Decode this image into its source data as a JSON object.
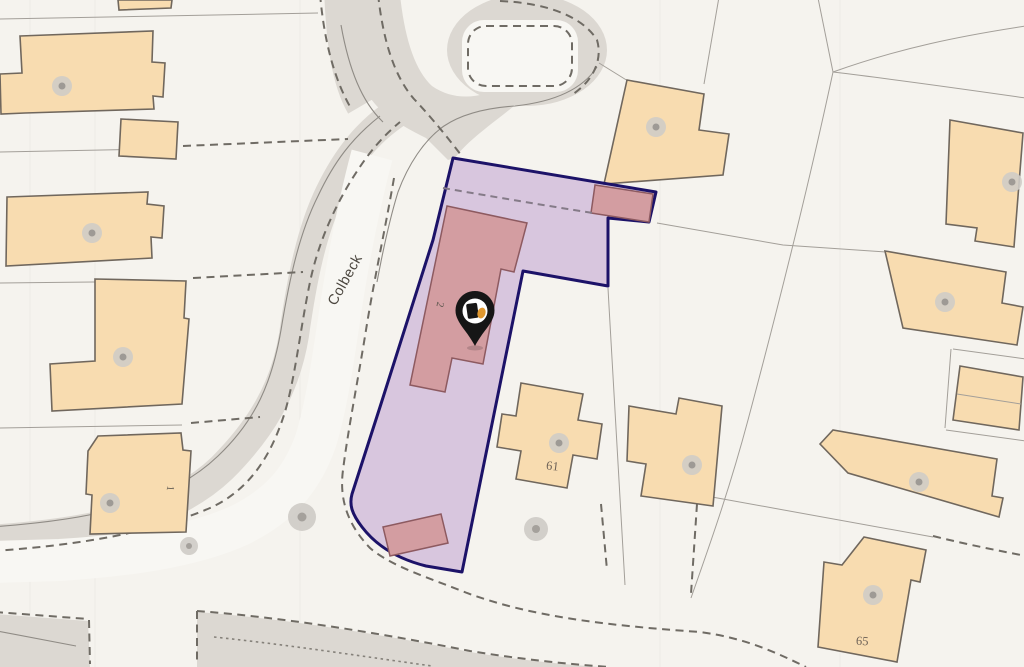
{
  "map": {
    "type": "property-location-map",
    "labels": {
      "street": "Colbeck",
      "plot": "2",
      "neighbor_1": "1",
      "neighbor_61": "61",
      "neighbor_65": "65"
    },
    "marker": {
      "kind": "location-pin",
      "logo": "black-and-orange-house-logo"
    },
    "colors": {
      "background": "#f5f3ee",
      "graticule": "#edebe7",
      "road_gray": "#dcd8d2",
      "road_surface": "#f8f7f3",
      "casing_line": "#8f8b85",
      "parcel_line": "#a39f99",
      "dashed_line": "#6f6b64",
      "plot_dash": "#857b88",
      "building_fill": "#f8dcb0",
      "building_stroke": "#70675d",
      "building_dot_outer": "#cfccc7",
      "building_dot_inner": "#9e9a95",
      "tree_outer": "#c9c6c1",
      "tree_inner": "#a5a19c",
      "boundary_fill": "#c6a9d4",
      "boundary_stroke": "#1c1268",
      "highlight_building_fill": "#d39da1",
      "highlight_building_stroke": "#8d5a60",
      "marker_black": "#161616",
      "marker_white": "#ffffff",
      "marker_orange": "#e0982f",
      "label_color": "#4b463e",
      "number_color": "#6e6257"
    }
  }
}
